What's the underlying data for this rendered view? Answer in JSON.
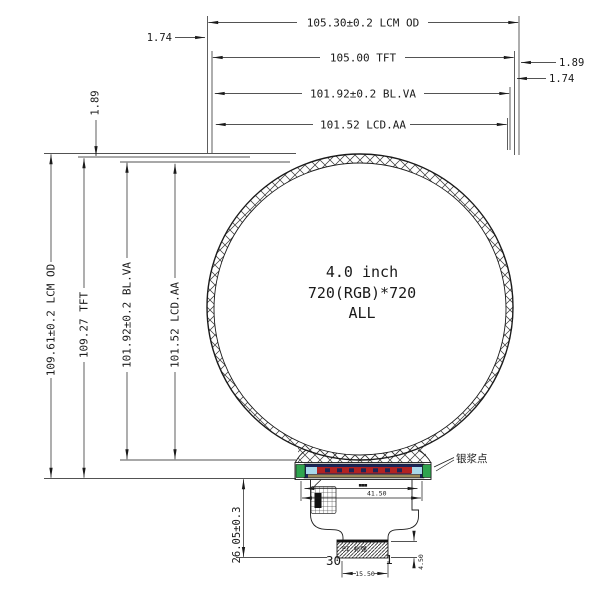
{
  "drawing": {
    "top_dims": {
      "lcm_od": "105.30±0.2 LCM OD",
      "tft": "105.00 TFT",
      "bl_va": "101.92±0.2 BL.VA",
      "lcd_aa": "101.52 LCD.AA",
      "offset_left": "1.74",
      "offset_right_1": "1.89",
      "offset_right_2": "1.74"
    },
    "left_dims": {
      "lcm_od": "109.61±0.2 LCM OD",
      "tft": "109.27 TFT",
      "bl_va": "101.92±0.2 BL.VA",
      "lcd_aa": "101.52 LCD.AA",
      "offset_top": "1.89"
    },
    "center": {
      "size": "4.0 inch",
      "resolution": "720(RGB)*720",
      "note": "ALL"
    },
    "bottom": {
      "fpc_height": "26.05±0.3",
      "bonding_width": "41.50",
      "micro_label": "■■■",
      "connector_width": "15.50",
      "connector_height": "4.50",
      "pin_first": "30",
      "pin_last": "1",
      "silver_paste": "银浆点",
      "stiffener": "PI 补强"
    }
  },
  "colors": {
    "line": "#1a1a1a",
    "green_pad": "#2fa44f",
    "navy_bar": "#1b2456",
    "red_stripe": "#b22222",
    "light_blue": "#a8d8ea",
    "tan_stripe": "#9a8a5a"
  }
}
